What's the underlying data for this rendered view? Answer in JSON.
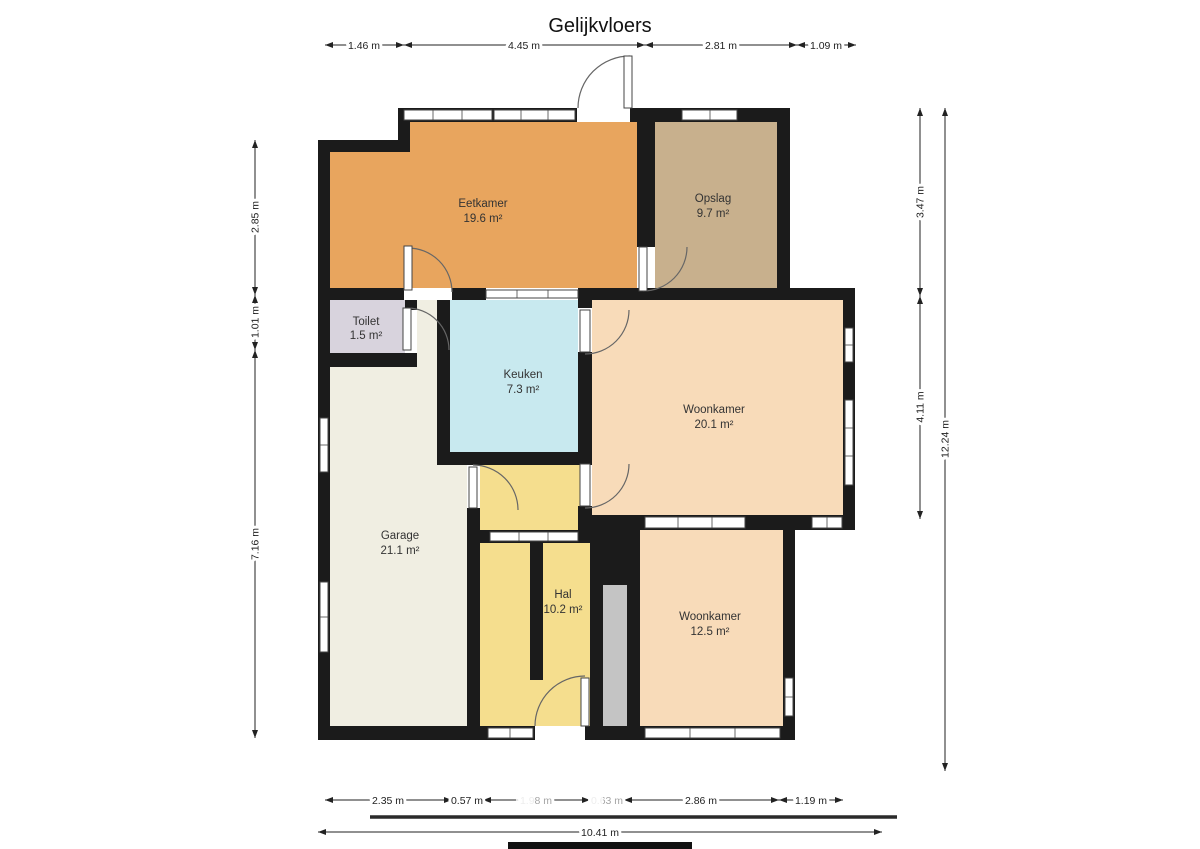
{
  "title": "Gelijkvloers",
  "rooms": [
    {
      "name": "Eetkamer",
      "area": "19.6 m²",
      "color": "#E8A55E"
    },
    {
      "name": "Opslag",
      "area": "9.7 m²",
      "color": "#C8B08D"
    },
    {
      "name": "Toilet",
      "area": "1.5 m²",
      "color": "#D8D3DD"
    },
    {
      "name": "Keuken",
      "area": "7.3 m²",
      "color": "#C8E9EF"
    },
    {
      "name": "Woonkamer",
      "area": "20.1 m²",
      "color": "#F8DBB9"
    },
    {
      "name": "Garage",
      "area": "21.1 m²",
      "color": "#F0EEE2"
    },
    {
      "name": "Hal",
      "area": "10.2 m²",
      "color": "#F5DE8E"
    },
    {
      "name": "Woonkamer",
      "area": "12.5 m²",
      "color": "#F8DBB9"
    }
  ],
  "colors": {
    "wall": "#1b1b1b",
    "shaft": "#C4C4C4"
  },
  "dimensions": {
    "top": [
      "1.46 m",
      "4.45 m",
      "2.81 m",
      "1.09 m"
    ],
    "left": [
      "2.85 m",
      "1.01 m",
      "7.16 m"
    ],
    "right": [
      "3.47 m",
      "4.11 m"
    ],
    "right_total": "12.24 m",
    "bottom": [
      "2.35 m",
      "0.57 m",
      "1.98 m",
      "0.63 m",
      "2.86 m",
      "1.19 m"
    ],
    "bottom_total": "10.41 m"
  }
}
